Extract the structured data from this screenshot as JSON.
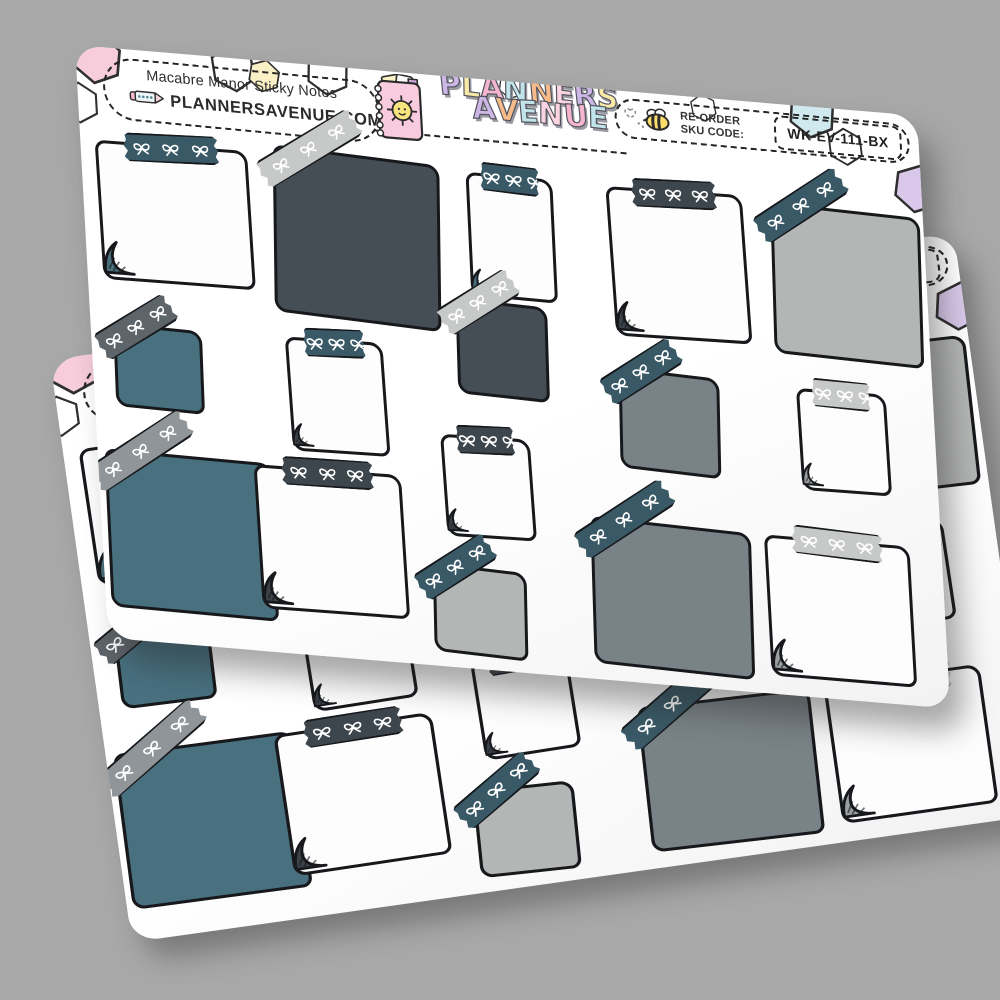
{
  "background_color": "#a8a8a8",
  "sheet": {
    "title": "Macabre Manor Sticky Notes",
    "website": "PLANNERSAVENUE.COM",
    "brand_line1": [
      [
        "P",
        "#cdb7e6"
      ],
      [
        "L",
        "#f8e9a6"
      ],
      [
        "A",
        "#f6b5cf"
      ],
      [
        "N",
        "#c0e4ea"
      ],
      [
        "N",
        "#f6ba8b"
      ],
      [
        "E",
        "#fad5e0"
      ],
      [
        "R",
        "#cdb7e6"
      ],
      [
        "S",
        "#f8e9a6"
      ]
    ],
    "brand_line2": [
      [
        "A",
        "#cdb7e6"
      ],
      [
        "V",
        "#f6ba8b"
      ],
      [
        "E",
        "#c0e4ea"
      ],
      [
        "N",
        "#fad5e0"
      ],
      [
        "U",
        "#f6b5cf"
      ],
      [
        "E",
        "#c0e4ea"
      ]
    ],
    "reorder_line1": "RE-ORDER",
    "reorder_line2": "SKU CODE:",
    "sku": "WK-EV-111-BX",
    "colors": {
      "sheet_bg": "#fdfdfe",
      "outline": "#17181c",
      "note_fills": {
        "white": "#fdfdfd",
        "charcoal": "#454e54",
        "teal": "#48707f",
        "gray": "#798286",
        "lightgray": "#b4b6b5"
      },
      "tape_fills": {
        "teal": "#3a5966",
        "charcoal": "#3d464c",
        "silver": "#c7c9c8",
        "gray": "#8f9598",
        "darkgray": "#5d646a"
      },
      "curl_fills": {
        "teal": "#4a707d",
        "dark": "#3a4148",
        "gray": "#9aa0a2"
      },
      "bow": "#ffffff",
      "hex_pink": "#f7cddc",
      "hex_yellow": "#faf0c6",
      "hex_blue": "#cfe9ee",
      "hex_purple": "#d9c8ea"
    },
    "hexagons": [
      {
        "x": -6,
        "y": -16,
        "s": 54,
        "fill": "#f7cddc",
        "r": 8
      },
      {
        "x": 134,
        "y": -14,
        "s": 48,
        "fill": "none",
        "r": -6
      },
      {
        "x": 172,
        "y": -2,
        "s": 34,
        "fill": "#faf0c6",
        "r": 12
      },
      {
        "x": 230,
        "y": -16,
        "s": 46,
        "fill": "none",
        "r": 4
      },
      {
        "x": -20,
        "y": 36,
        "s": 42,
        "fill": "none",
        "r": 0
      },
      {
        "x": 424,
        "y": -8,
        "s": 26,
        "fill": "none",
        "r": 10
      },
      {
        "x": 616,
        "y": -4,
        "s": 28,
        "fill": "none",
        "r": -8
      },
      {
        "x": 714,
        "y": -18,
        "s": 50,
        "fill": "#cfe9ee",
        "r": 6
      },
      {
        "x": 752,
        "y": 18,
        "s": 38,
        "fill": "none",
        "r": -4
      },
      {
        "x": 816,
        "y": 48,
        "s": 50,
        "fill": "#d9c8ea",
        "r": 10
      }
    ],
    "notes": [
      {
        "x": 15,
        "y": 92,
        "w": 153,
        "h": 138,
        "rot": -0.5,
        "fill": "white",
        "tape": {
          "pos": "top",
          "color": "teal",
          "rot": -2
        },
        "curl": "teal"
      },
      {
        "x": 190,
        "y": 86,
        "w": 167,
        "h": 166,
        "rot": 2.5,
        "fill": "charcoal",
        "tape": {
          "pos": "diag",
          "color": "silver",
          "rot": -36
        },
        "curl": null
      },
      {
        "x": 386,
        "y": 94,
        "w": 87,
        "h": 123,
        "rot": 0.5,
        "fill": "white",
        "tape": {
          "pos": "top",
          "color": "teal",
          "rot": 1
        },
        "curl": "teal"
      },
      {
        "x": 528,
        "y": 95,
        "w": 137,
        "h": 148,
        "rot": -1,
        "fill": "white",
        "tape": {
          "pos": "top",
          "color": "charcoal",
          "rot": -1.5
        },
        "curl": "dark"
      },
      {
        "x": 690,
        "y": 100,
        "w": 150,
        "h": 150,
        "rot": 1.5,
        "fill": "lightgray",
        "tape": {
          "pos": "diag",
          "color": "teal",
          "rot": -37
        },
        "curl": null
      },
      {
        "x": 22,
        "y": 274,
        "w": 89,
        "h": 83,
        "rot": 1,
        "fill": "teal",
        "tape": {
          "pos": "diag",
          "color": "darkgray",
          "rot": -35
        },
        "curl": null
      },
      {
        "x": 196,
        "y": 272,
        "w": 98,
        "h": 113,
        "rot": -1,
        "fill": "white",
        "tape": {
          "pos": "top",
          "color": "teal",
          "rot": -2
        },
        "curl": "dark"
      },
      {
        "x": 368,
        "y": 221,
        "w": 92,
        "h": 95,
        "rot": 1.5,
        "fill": "charcoal",
        "tape": {
          "pos": "diag",
          "color": "silver",
          "rot": -36
        },
        "curl": null
      },
      {
        "x": 528,
        "y": 277,
        "w": 101,
        "h": 100,
        "rot": 2,
        "fill": "gray",
        "tape": {
          "pos": "diag",
          "color": "teal",
          "rot": -37
        },
        "curl": null
      },
      {
        "x": 708,
        "y": 281,
        "w": 90,
        "h": 101,
        "rot": -0.5,
        "fill": "white",
        "tape": {
          "pos": "top",
          "color": "silver",
          "rot": 1
        },
        "curl": "gray"
      },
      {
        "x": 6,
        "y": 400,
        "w": 168,
        "h": 157,
        "rot": 0.5,
        "fill": "teal",
        "tape": {
          "pos": "diag",
          "color": "gray",
          "rot": -36
        },
        "curl": null
      },
      {
        "x": 157,
        "y": 402,
        "w": 148,
        "h": 143,
        "rot": -0.5,
        "fill": "white",
        "tape": {
          "pos": "top",
          "color": "charcoal",
          "rot": -1
        },
        "curl": "dark"
      },
      {
        "x": 347,
        "y": 356,
        "w": 90,
        "h": 101,
        "rot": -1,
        "fill": "white",
        "tape": {
          "pos": "top",
          "color": "charcoal",
          "rot": -2
        },
        "curl": "dark"
      },
      {
        "x": 330,
        "y": 487,
        "w": 94,
        "h": 88,
        "rot": 2,
        "fill": "lightgray",
        "tape": {
          "pos": "diag",
          "color": "teal",
          "rot": -37
        },
        "curl": null
      },
      {
        "x": 491,
        "y": 428,
        "w": 161,
        "h": 146,
        "rot": 1.5,
        "fill": "gray",
        "tape": {
          "pos": "diag",
          "color": "teal",
          "rot": -37
        },
        "curl": null
      },
      {
        "x": 667,
        "y": 430,
        "w": 146,
        "h": 140,
        "rot": 0,
        "fill": "white",
        "tape": {
          "pos": "top",
          "color": "silver",
          "rot": 2
        },
        "curl": "gray"
      }
    ]
  }
}
